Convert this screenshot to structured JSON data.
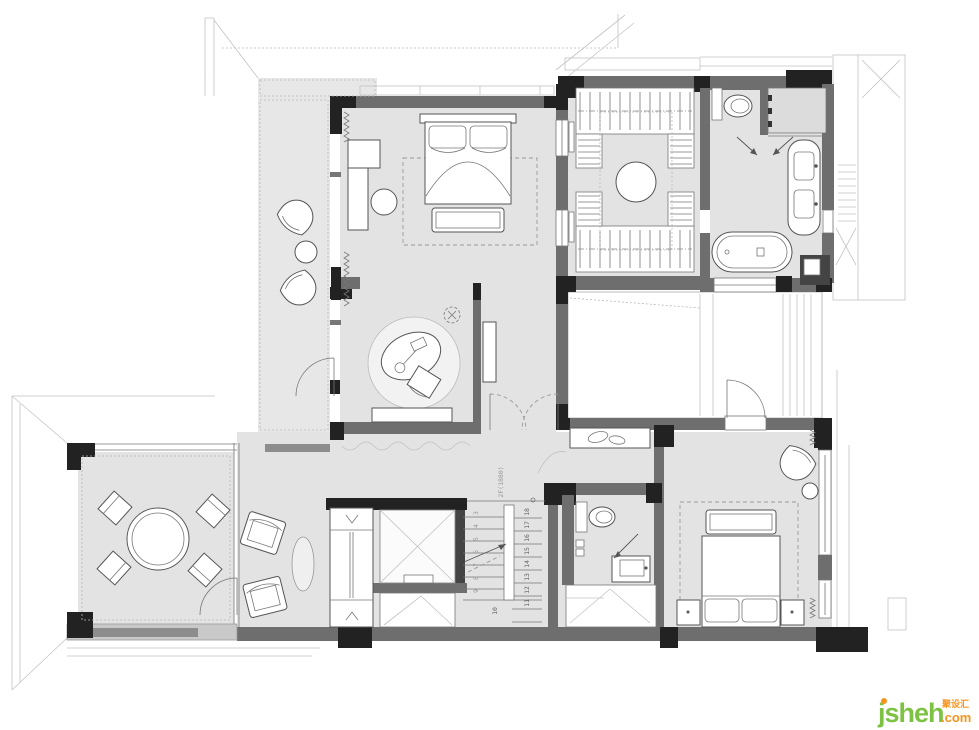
{
  "plan": {
    "stairs": {
      "annotation": "2F(1880)",
      "left_numbers": [
        "3",
        "4",
        "5",
        "6",
        "7",
        "8",
        "9"
      ],
      "landing_number": "10",
      "right_numbers": [
        "18",
        "17",
        "16",
        "15",
        "14",
        "13",
        "12",
        "11"
      ]
    },
    "colors": {
      "background": "#ffffff",
      "floor": "#e3e3e3",
      "wall": "#6e6e6e",
      "wall_dark": "#222222",
      "furniture_line": "#555555",
      "outline": "#c3c3c3",
      "watermark_green": "#7dc242",
      "watermark_orange": "#f7941d"
    },
    "watermark": {
      "brand": "jsheh",
      "cn_label": "聚设汇",
      "tld": ".com"
    }
  }
}
